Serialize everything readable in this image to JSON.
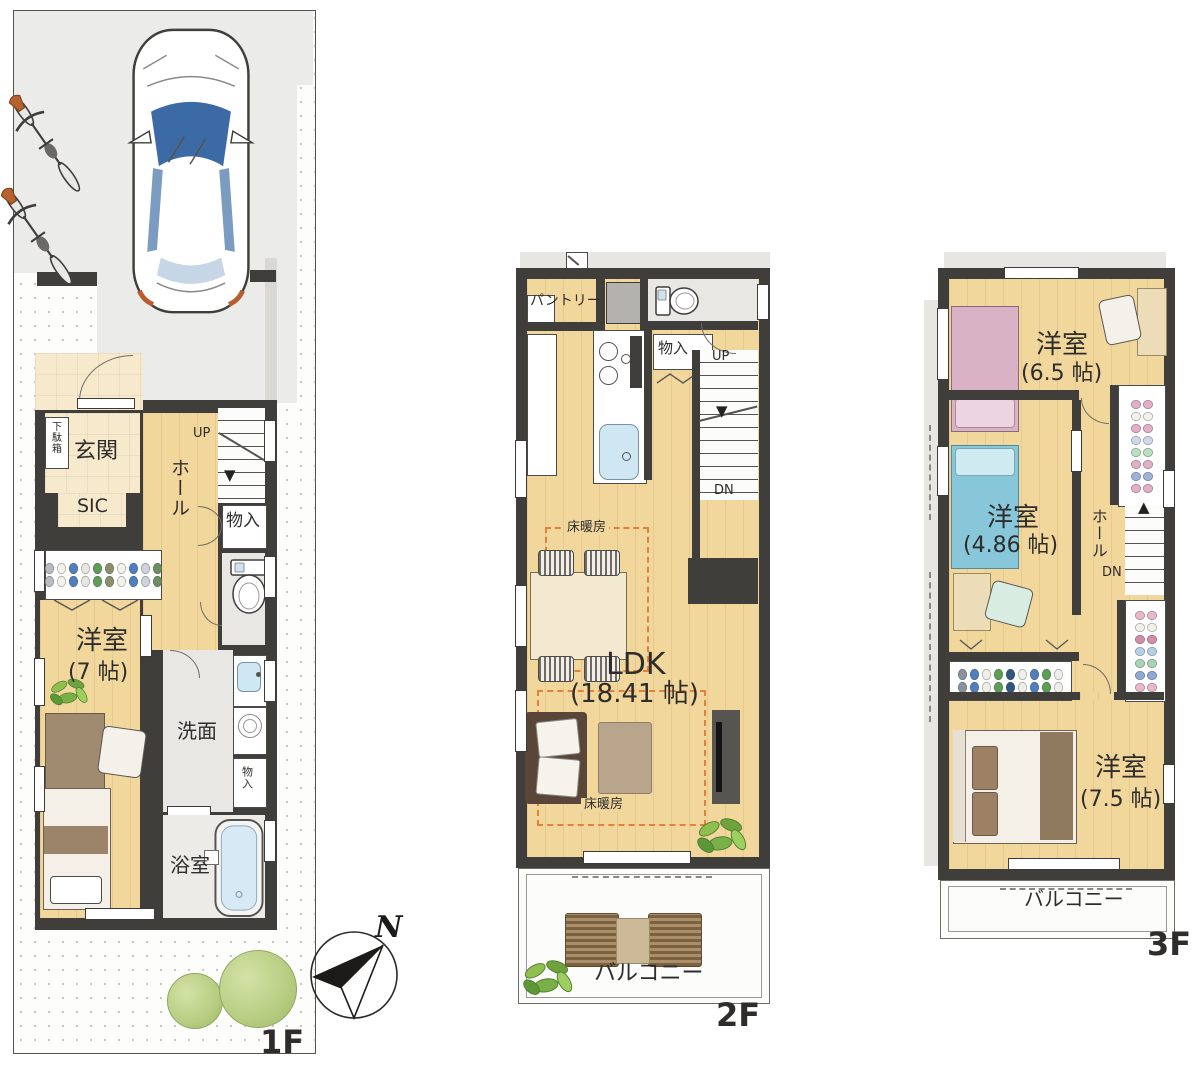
{
  "page": {
    "type": "house-floor-plan-drawing"
  },
  "colors": {
    "wall": "#403e3b",
    "wood_floor": "#f2d79d",
    "tile_floor": "#f7e9cc",
    "wet_area_floor": "#e9e7e3",
    "floor_heating_dash": "#e2813b",
    "water": "#cfe7f2",
    "greenery": "#8fbf4f"
  },
  "floor1": {
    "label": "1F",
    "north": "N",
    "shoe_cabinet": "下駄箱",
    "entrance": "玄関",
    "sic": "SIC",
    "hall": "ホール",
    "stairs_up": "UP",
    "storage_hall": "物入",
    "bedroom": "洋室",
    "bedroom_size": "(7 帖)",
    "washroom": "洗面",
    "storage_washroom": "物入",
    "bathroom": "浴室"
  },
  "floor2": {
    "label": "2F",
    "pantry": "パントリー",
    "storage": "物入",
    "stairs_up": "UP",
    "stairs_down": "DN",
    "floor_heating_dining": "床暖房",
    "floor_heating_living": "床暖房",
    "ldk": "LDK",
    "ldk_size": "(18.41 帖)",
    "balcony": "バルコニー"
  },
  "floor3": {
    "label": "3F",
    "bedroom_1": "洋室",
    "bedroom_1_size": "(6.5 帖)",
    "bedroom_2": "洋室",
    "bedroom_2_size": "(4.86 帖)",
    "hall": "ホール",
    "stairs_down": "DN",
    "bedroom_3": "洋室",
    "bedroom_3_size": "(7.5 帖)",
    "balcony": "バルコニー"
  }
}
